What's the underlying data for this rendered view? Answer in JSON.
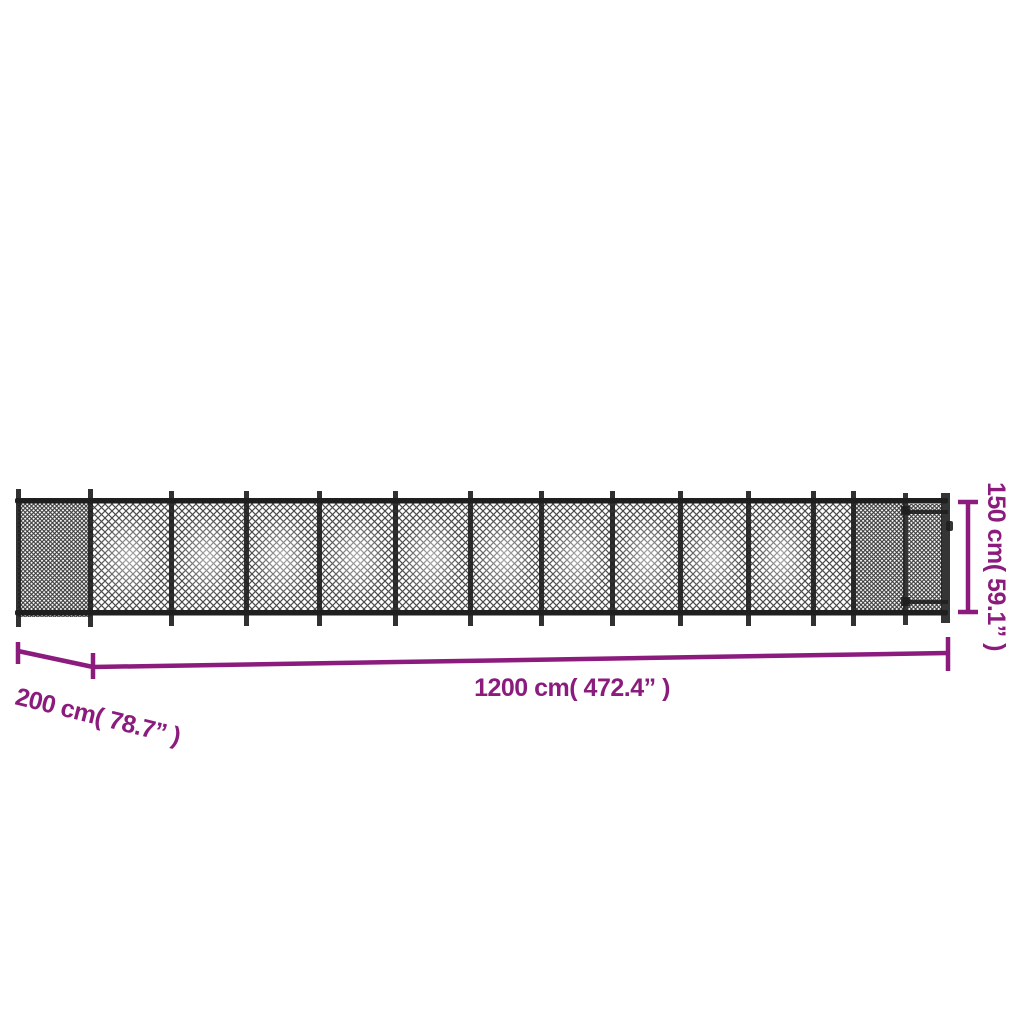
{
  "diagram": {
    "dimensions": {
      "width": {
        "label": "1200 cm( 472.4” )",
        "cm": 1200,
        "inches": 472.4
      },
      "depth": {
        "label": "200 cm( 78.7” )",
        "cm": 200,
        "inches": 78.7
      },
      "height": {
        "label": "150 cm( 59.1” )",
        "cm": 150,
        "inches": 59.1
      }
    },
    "colors": {
      "dimension_accent": "#8B1C7D",
      "fence": "#1f1f1f",
      "background": "#ffffff"
    }
  }
}
